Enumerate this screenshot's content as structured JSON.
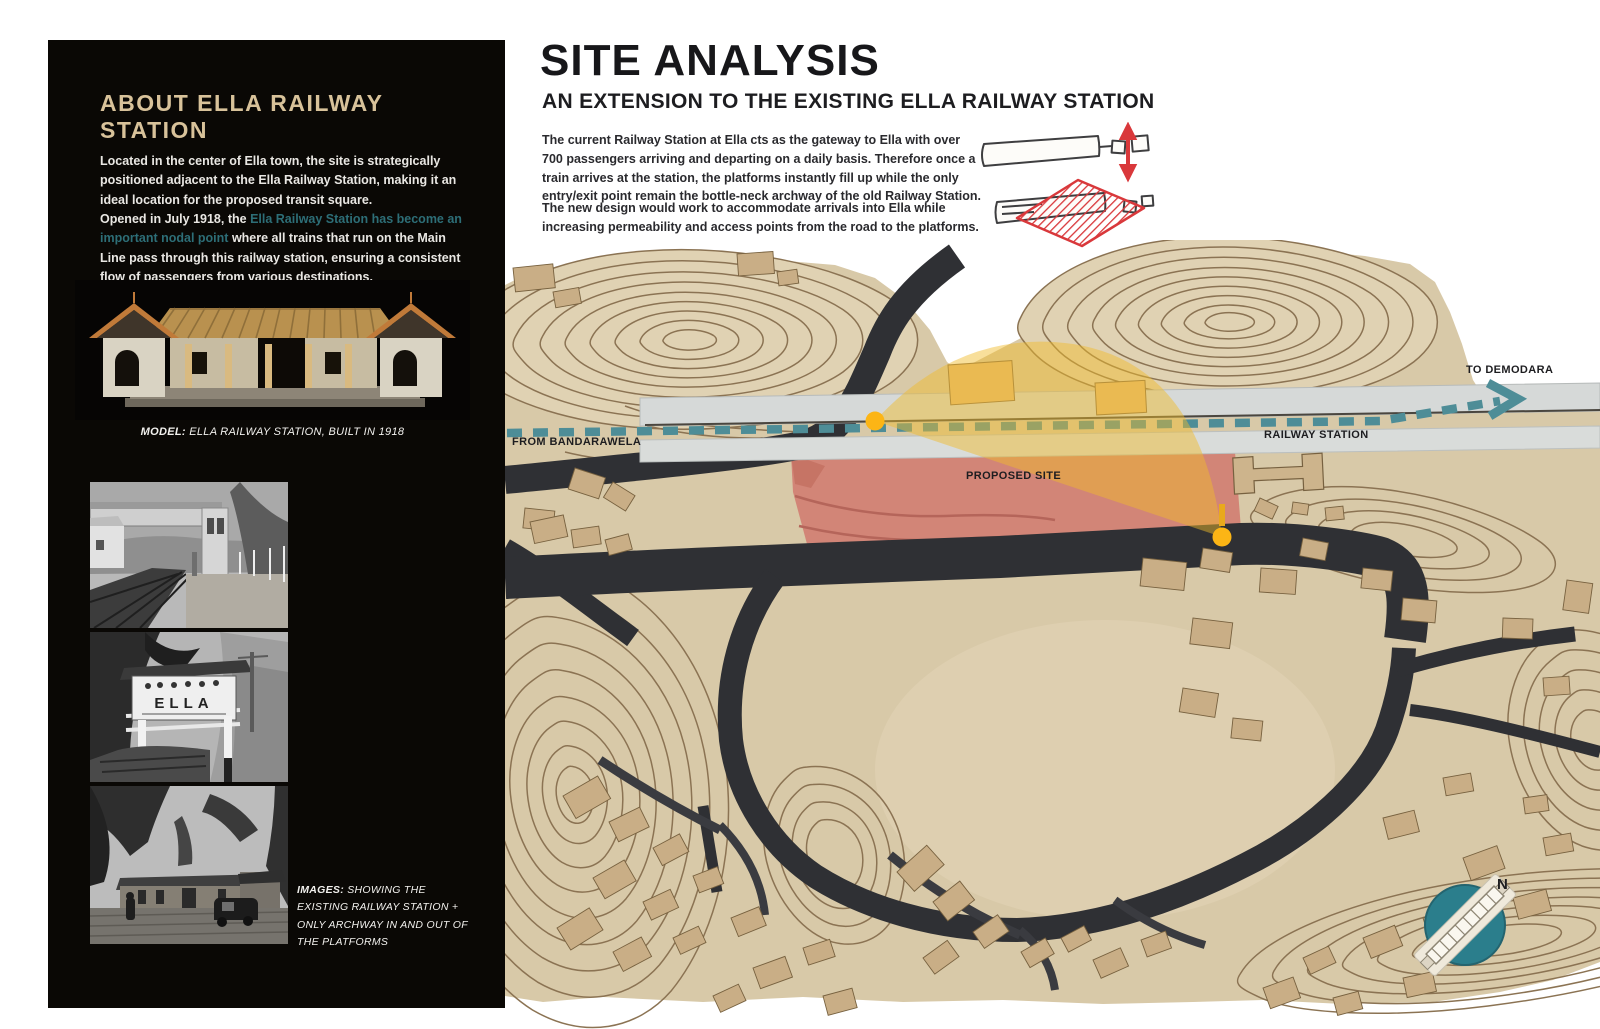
{
  "left_panel": {
    "heading": "ABOUT ELLA RAILWAY STATION",
    "para1": "Located in the center of Ella town, the site is strategically positioned adjacent to the Ella Railway Station, making it an ideal location for the proposed transit square.",
    "para2_prefix": "Opened in July 1918, the ",
    "para2_highlight": "Ella Railway Station has become an important nodal point",
    "para2_suffix": " where all trains that run on the Main Line pass through this railway station, ensuring a consistent flow of passengers from various destinations.",
    "model_caption_label": "MODEL:",
    "model_caption_text": " ELLA RAILWAY STATION, BUILT IN 1918",
    "images_caption_label": "IMAGES:",
    "images_caption_text": " SHOWING THE EXISTING RAILWAY STATION + ONLY ARCHWAY IN AND OUT OF THE PLATFORMS",
    "photo2_sign_text": "ELLA",
    "colors": {
      "heading": "#d8c29a",
      "highlight_text": "#2d6e77",
      "panel_bg": "#0a0805"
    }
  },
  "main": {
    "title": "SITE ANALYSIS",
    "subtitle": "AN EXTENSION TO THE EXISTING ELLA RAILWAY STATION",
    "para1": "The current Railway Station at Ella cts as the gateway to Ella with over 700 passengers arriving and departing on a daily basis. Therefore once a train arrives at the station, the platforms instantly fill up while the only entry/exit point remain the bottle-neck archway of the old Railway Station.",
    "para2": "The new design would work to accommodate arrivals into Ella while increasing permeability and access points from the road to the platforms."
  },
  "map": {
    "labels": {
      "from": "FROM BANDARAWELA",
      "to": "TO DEMODARA",
      "station": "RAILWAY STATION",
      "site": "PROPOSED SITE",
      "north": "N"
    },
    "colors": {
      "route_dash": "#4e8d97",
      "site_overlay": "#d28577",
      "highlight_arc": "#f1bb2a",
      "node_dot": "#fcb515",
      "cardboard": "#d8c9a8",
      "road": "#2f3034",
      "compass": "#2b7e8c",
      "sketch_red": "#d9383b"
    }
  }
}
